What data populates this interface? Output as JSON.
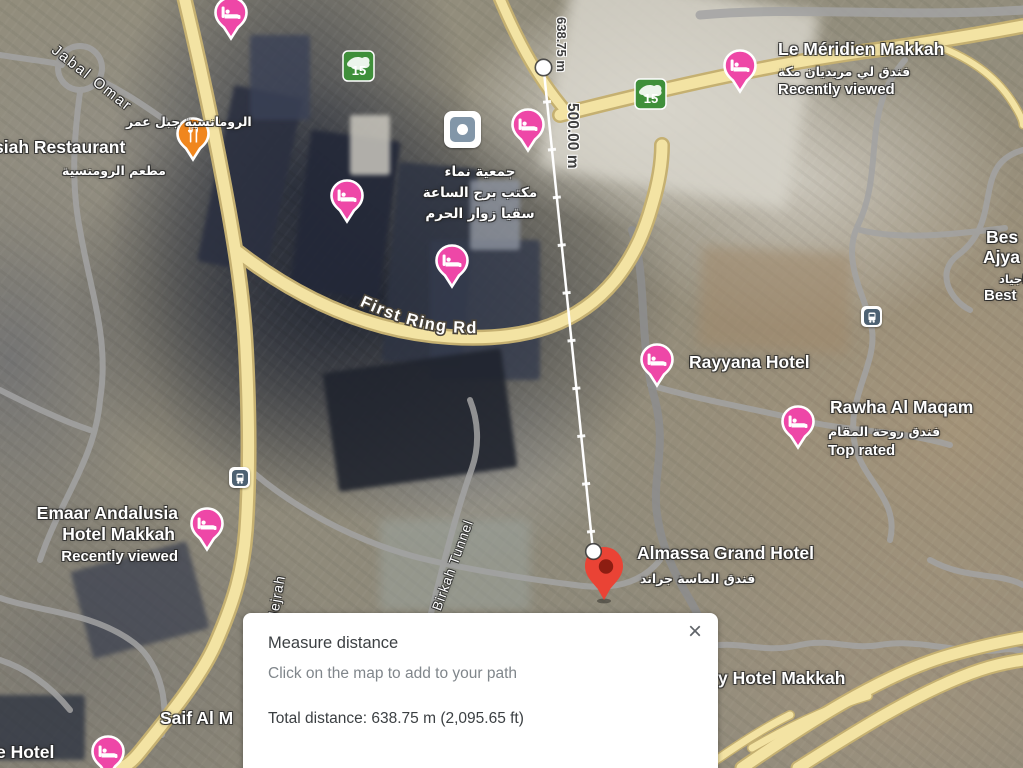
{
  "measure_panel": {
    "title": "Measure distance",
    "hint": "Click on the map to add to your path",
    "total": "Total distance: 638.75 m (2,095.65 ft)",
    "close_icon": "×"
  },
  "measure_line": {
    "total_distance_label": "638.75 m",
    "interval_label": "500.00 m"
  },
  "roads": {
    "first_ring": "First Ring Rd",
    "jabal_omar": "Jabal Omar",
    "hejrah": "Hejrah",
    "al_birkah_tunnel": "Al Birkah Tunnel",
    "route_number": "15"
  },
  "pois": {
    "le_meridien": {
      "name": "Le Méridien Makkah",
      "arabic": "فندق لي مريديان مكة",
      "status": "Recently viewed"
    },
    "romansiah": {
      "arabic_top": "الرومانسية جبل عمر",
      "name": "siah Restaurant",
      "arabic_bottom": "مطعم الرومنسية"
    },
    "clock_tower": {
      "line1": "جمعية نماء",
      "line2": "مكتب برج الساعة",
      "line3": "سقيا زوار الحرم"
    },
    "rayyana": {
      "name": "Rayyana Hotel"
    },
    "rawha": {
      "name": "Rawha Al Maqam",
      "arabic": "فندق روحة المقام",
      "status": "Top rated"
    },
    "ajyad": {
      "line1": "Bes",
      "line2": "Ajya",
      "arabic": "اجياد",
      "line3": "Best"
    },
    "emaar": {
      "name_line1": "Emaar Andalusia",
      "name_line2": "Hotel Makkah",
      "status": "Recently viewed"
    },
    "almassa": {
      "name": "Almassa Grand Hotel",
      "arabic": "فندق الماسة جراند"
    },
    "hotel_makkah_partial": {
      "name": "y Hotel Makkah"
    },
    "saif": {
      "name": "Saif Al M"
    },
    "e_hotel": {
      "name": "e Hotel"
    }
  }
}
